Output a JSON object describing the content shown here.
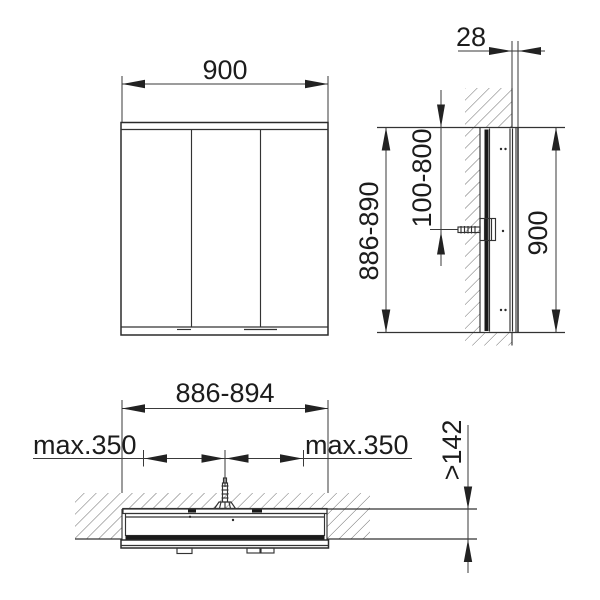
{
  "colors": {
    "line": "#333333",
    "text": "#1c1c1c",
    "arrow": "#222222",
    "hatch": "#5f5f5f",
    "panel_dark": "#1a1a1a",
    "background": "#ffffff"
  },
  "front_view": {
    "width_dim": "900"
  },
  "side_view": {
    "protrusion_dim": "28",
    "recess_height_dim": "886-890",
    "mounting_height_dim": "100-800",
    "height_dim": "900"
  },
  "plan_view": {
    "recess_width_dim": "886-894",
    "max_side_left_dim": "max.350",
    "max_side_right_dim": "max.350",
    "recess_depth_dim": ">142"
  }
}
